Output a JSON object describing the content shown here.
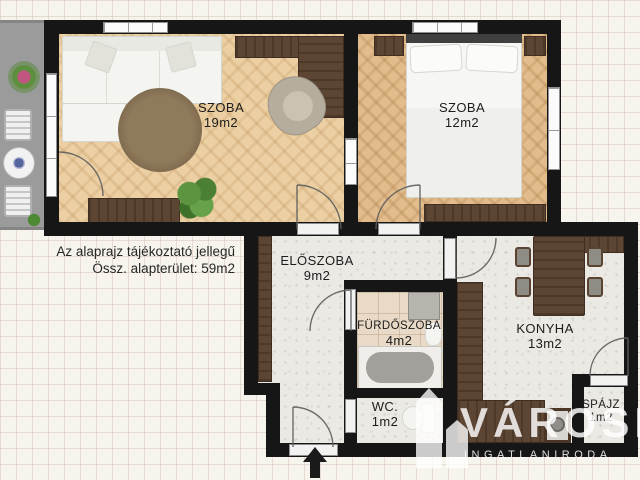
{
  "note": {
    "line1": "Az alaprajz tájékoztató jellegű",
    "line2": "Össz. alapterület: 59m2"
  },
  "rooms": [
    {
      "name": "SZOBA",
      "area": "19m2"
    },
    {
      "name": "SZOBA",
      "area": "12m2"
    },
    {
      "name": "ELŐSZOBA",
      "area": "9m2"
    },
    {
      "name": "FÜRDŐSZOBA",
      "area": "4m2"
    },
    {
      "name": "KONYHA",
      "area": "13m2"
    },
    {
      "name": "WC.",
      "area": "1m2"
    },
    {
      "name": "SPÁJZ",
      "area": "1m2"
    }
  ],
  "watermark": {
    "brand": "VÁROSI",
    "subtitle": "INGATLANIRODA"
  },
  "colors": {
    "wall": "#161616",
    "wood_floor_living": "#ecd0a4",
    "wood_floor_bedroom": "#e2bc8c",
    "furniture_wood": "#5d4533",
    "balcony": "#9b9b9b",
    "terrazzo_floor": "#ebe9e4",
    "bath_tile": "#e8dac6",
    "watermark": "#ffffff"
  }
}
